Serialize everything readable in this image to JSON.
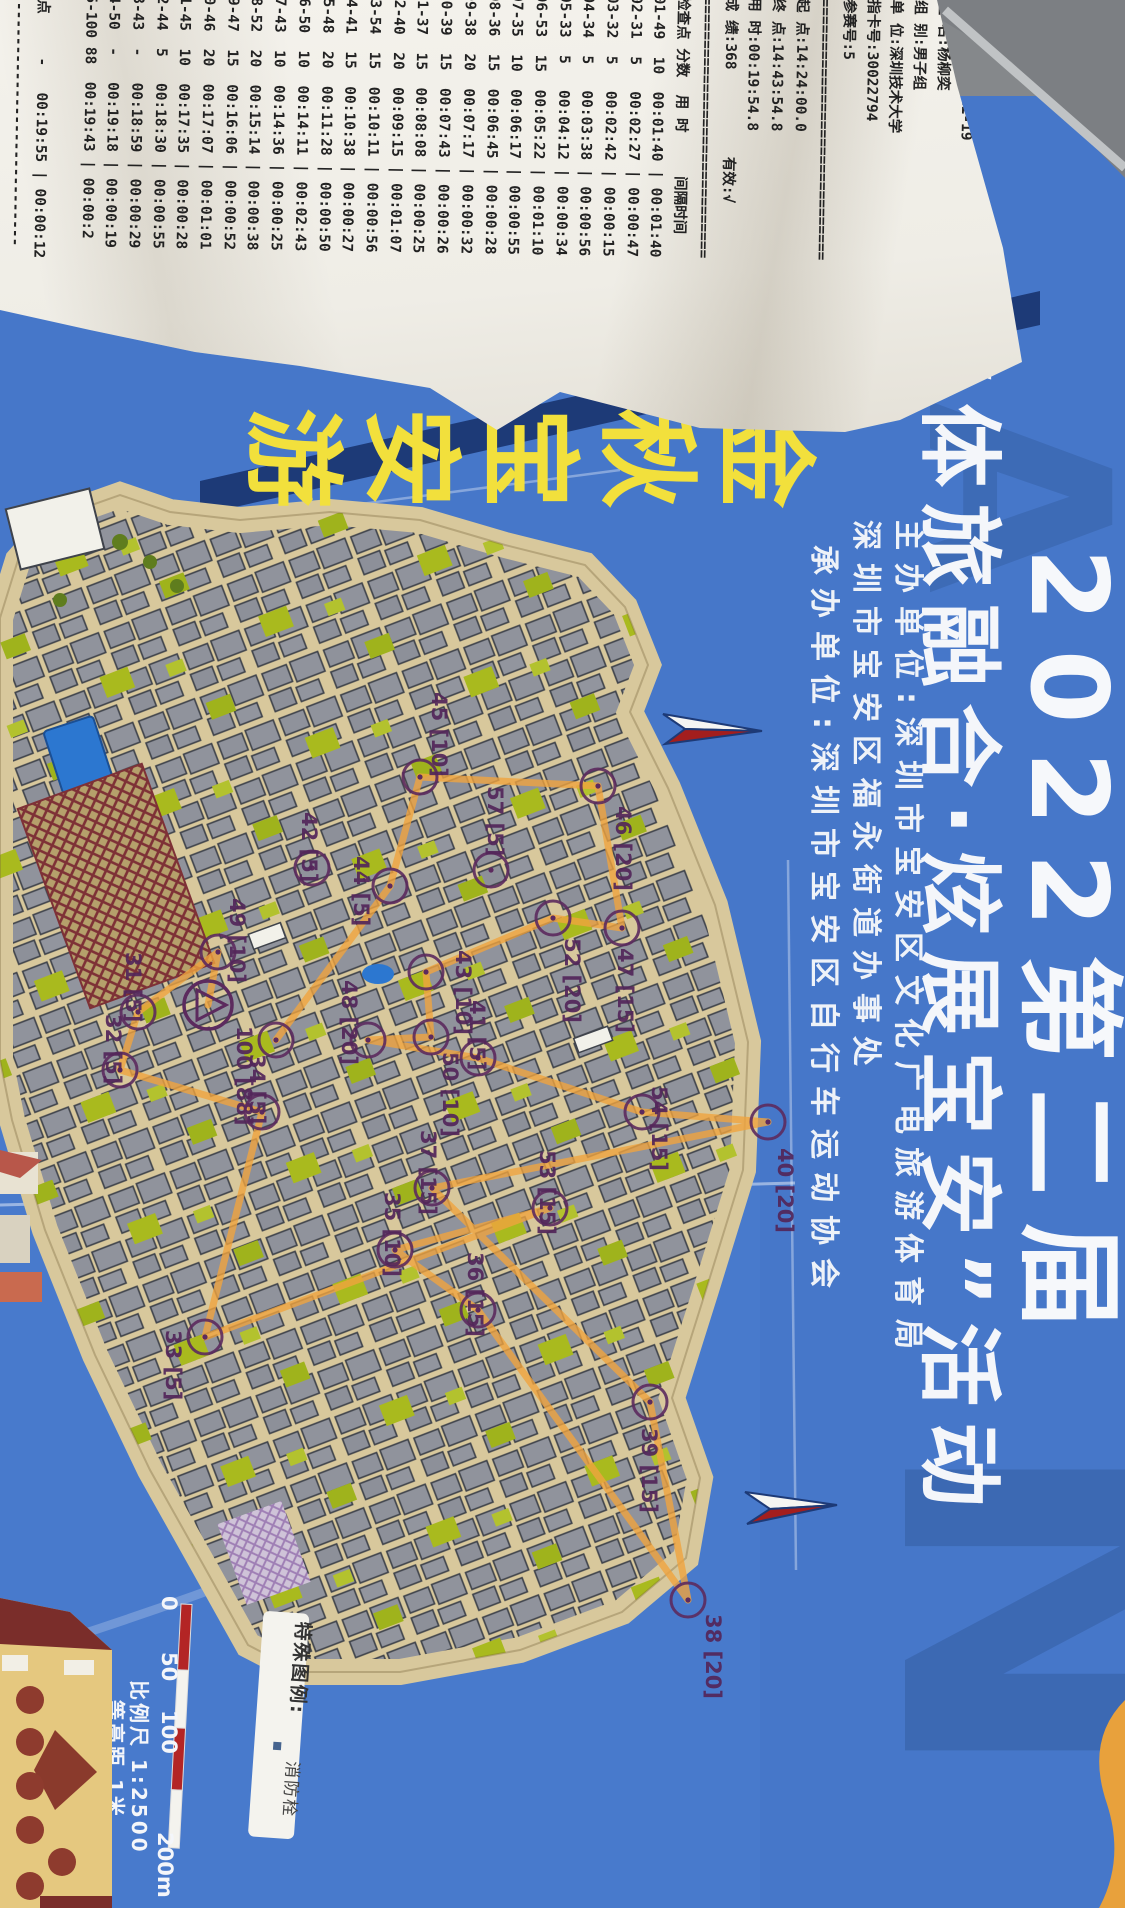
{
  "colors": {
    "sheet_blue": "#4677c9",
    "navy_band": "#1d3a77",
    "title_yellow": "#f2e03c",
    "map_tan": "#d8c89c",
    "building_grey": "#8f929b",
    "veg_green": "#a9ba1e",
    "route_orange": "#f0a43e",
    "control_purple": "#5c2a5e",
    "scale_red": "#b32525",
    "watermark_blue": "#3b67b0"
  },
  "receipt": {
    "title": "2022第二届 \"体旅融合 炫展宝安\"",
    "title2": "活动",
    "fields": [
      "竞赛日:2022-11-19",
      "姓 名:杨柳奕",
      "组 别:男子组",
      "单 位:深圳技术大学",
      "指卡号:30022794",
      "参赛号:5"
    ],
    "separator": "==============================",
    "results": [
      "起 点:14:24:00.0",
      "终 点:14:43:54.8",
      "用 时:00:19:54.8",
      "成 绩:368          有效:√"
    ],
    "table_header": "检查点 分数  用 时     间隔时间",
    "rows": [
      [
        "01-49",
        "10",
        "00:01:40",
        "00:01:40"
      ],
      [
        "02-31",
        "5",
        "00:02:27",
        "00:00:47"
      ],
      [
        "03-32",
        "5",
        "00:02:42",
        "00:00:15"
      ],
      [
        "04-34",
        "5",
        "00:03:38",
        "00:00:56"
      ],
      [
        "05-33",
        "5",
        "00:04:12",
        "00:00:34"
      ],
      [
        "06-53",
        "15",
        "00:05:22",
        "00:01:10"
      ],
      [
        "07-35",
        "10",
        "00:06:17",
        "00:00:55"
      ],
      [
        "08-36",
        "15",
        "00:06:45",
        "00:00:28"
      ],
      [
        "09-38",
        "20",
        "00:07:17",
        "00:00:32"
      ],
      [
        "10-39",
        "15",
        "00:07:43",
        "00:00:26"
      ],
      [
        "11-37",
        "15",
        "00:08:08",
        "00:00:25"
      ],
      [
        "12-40",
        "20",
        "00:09:15",
        "00:01:07"
      ],
      [
        "13-54",
        "15",
        "00:10:11",
        "00:00:56"
      ],
      [
        "14-41",
        "15",
        "00:10:38",
        "00:00:27"
      ],
      [
        "15-48",
        "20",
        "00:11:28",
        "00:00:50"
      ],
      [
        "16-50",
        "10",
        "00:14:11",
        "00:02:43"
      ],
      [
        "17-43",
        "10",
        "00:14:36",
        "00:00:25"
      ],
      [
        "18-52",
        "20",
        "00:15:14",
        "00:00:38"
      ],
      [
        "19-47",
        "15",
        "00:16:06",
        "00:00:52"
      ],
      [
        "20-46",
        "20",
        "00:17:07",
        "00:01:01"
      ],
      [
        "21-45",
        "10",
        "00:17:35",
        "00:00:28"
      ],
      [
        "22-44",
        "5",
        "00:18:30",
        "00:00:55"
      ],
      [
        "23-43",
        "-",
        "00:18:59",
        "00:00:29"
      ],
      [
        "24-50",
        "-",
        "00:19:18",
        "00:00:19"
      ],
      [
        "25-100",
        "88",
        "00:19:43",
        "00:00:2"
      ]
    ],
    "wrap_line": "5",
    "finish_row": [
      "终点",
      "-",
      "00:19:55",
      "00:00:12"
    ],
    "trailing_rule": "------------------------------"
  },
  "sheet": {
    "map_name": "金秋宝安游",
    "title_line1": "2022第二届",
    "title_line2": "“体旅融合·炫展宝安”活动",
    "organizers": [
      "主办单位:深圳市宝安区文化广电旅游体育局",
      "        深圳市宝安区福永街道办事处",
      "承办单位:深圳市宝安区自行车运动协会"
    ],
    "watermark_letters": [
      "A",
      "N"
    ]
  },
  "map": {
    "start": {
      "x": 208,
      "y": 1005
    },
    "controls": [
      {
        "id": "45",
        "score": "10",
        "x": 420,
        "y": 777,
        "lx": 432,
        "ly": 692
      },
      {
        "id": "57",
        "score": "5",
        "x": 491,
        "y": 870,
        "lx": 488,
        "ly": 786
      },
      {
        "id": "44",
        "score": "5",
        "x": 390,
        "y": 886,
        "lx": 354,
        "ly": 856
      },
      {
        "id": "43",
        "score": "10",
        "x": 426,
        "y": 972,
        "lx": 456,
        "ly": 950
      },
      {
        "id": "46",
        "score": "20",
        "x": 598,
        "y": 786,
        "lx": 616,
        "ly": 806
      },
      {
        "id": "47",
        "score": "15",
        "x": 622,
        "y": 928,
        "lx": 618,
        "ly": 948
      },
      {
        "id": "52",
        "score": "20",
        "x": 553,
        "y": 918,
        "lx": 565,
        "ly": 938
      },
      {
        "id": "50",
        "score": "10",
        "x": 431,
        "y": 1037,
        "lx": 443,
        "ly": 1052
      },
      {
        "id": "48",
        "score": "20",
        "x": 368,
        "y": 1040,
        "lx": 342,
        "ly": 980
      },
      {
        "id": "41",
        "score": "5",
        "x": 478,
        "y": 1058,
        "lx": 470,
        "ly": 1000
      },
      {
        "id": "42",
        "score": "5",
        "x": 312,
        "y": 868,
        "lx": 302,
        "ly": 812
      },
      {
        "id": "100",
        "score": "88",
        "x": 276,
        "y": 1040,
        "lx": 237,
        "ly": 1026
      },
      {
        "id": "49",
        "score": "10",
        "x": 218,
        "y": 952,
        "lx": 230,
        "ly": 898
      },
      {
        "id": "31",
        "score": "5",
        "x": 138,
        "y": 1012,
        "lx": 126,
        "ly": 952
      },
      {
        "id": "32",
        "score": "5",
        "x": 120,
        "y": 1070,
        "lx": 106,
        "ly": 1014
      },
      {
        "id": "34",
        "score": "5",
        "x": 262,
        "y": 1112,
        "lx": 250,
        "ly": 1054
      },
      {
        "id": "33",
        "score": "5",
        "x": 205,
        "y": 1337,
        "lx": 166,
        "ly": 1330
      },
      {
        "id": "35",
        "score": "10",
        "x": 395,
        "y": 1250,
        "lx": 385,
        "ly": 1192
      },
      {
        "id": "36",
        "score": "15",
        "x": 478,
        "y": 1310,
        "lx": 468,
        "ly": 1252
      },
      {
        "id": "37",
        "score": "15",
        "x": 432,
        "y": 1188,
        "lx": 421,
        "ly": 1130
      },
      {
        "id": "53",
        "score": "15",
        "x": 550,
        "y": 1208,
        "lx": 540,
        "ly": 1150
      },
      {
        "id": "54",
        "score": "15",
        "x": 642,
        "y": 1112,
        "lx": 652,
        "ly": 1086
      },
      {
        "id": "40",
        "score": "20",
        "x": 768,
        "y": 1122,
        "lx": 778,
        "ly": 1148
      },
      {
        "id": "39",
        "score": "15",
        "x": 650,
        "y": 1402,
        "lx": 642,
        "ly": 1428
      },
      {
        "id": "38",
        "score": "20",
        "x": 688,
        "y": 1600,
        "lx": 706,
        "ly": 1614
      }
    ],
    "route_points": "208,1005 218,952 138,1012 120,1070 262,1112 205,1337 550,1208 395,1250 478,1310 688,1600 650,1402 432,1188 768,1122 642,1112 478,1058 368,1040 431,1037 426,972 553,918 622,928 598,786 420,777 390,886 276,1040",
    "scale": {
      "labels": [
        "0",
        "50",
        "100",
        "200m"
      ],
      "ratio": "比例尺 1:2500",
      "contour": "等高距 1米"
    },
    "legend": {
      "title": "特殊图例:",
      "item": "消防栓"
    }
  }
}
